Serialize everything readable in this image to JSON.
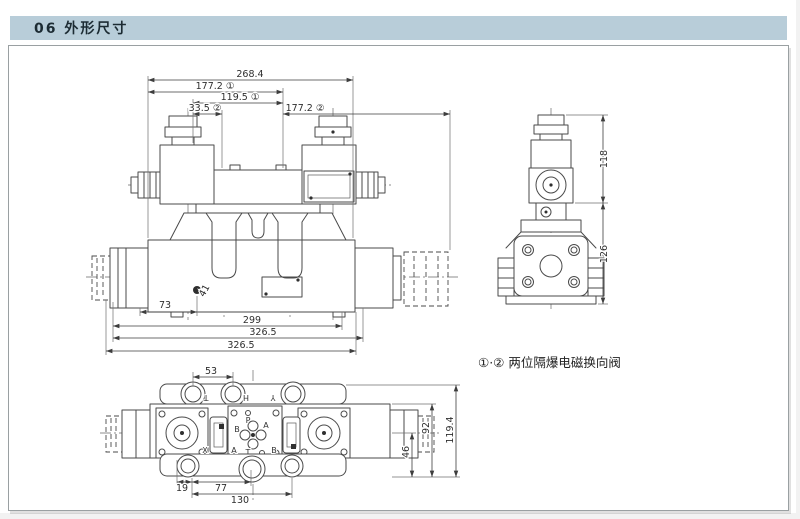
{
  "header": {
    "title": "06 外形尺寸"
  },
  "note": {
    "text": "①·② 两位隔爆电磁换向阀"
  },
  "front_view": {
    "dim_268_4": "268.4",
    "dim_177_2_a": "177.2 ①",
    "dim_119_5": "119.5 ①",
    "dim_33_5": "33.5 ②",
    "dim_177_2_b": "177.2 ②",
    "dim_73": "73",
    "dim_299": "299",
    "dim_326_5_a": "326.5",
    "dim_326_5_b": "326.5",
    "dim_41": "41"
  },
  "side_view": {
    "dim_118": "118",
    "dim_126": "126"
  },
  "bottom_view": {
    "dim_53": "53",
    "dim_19": "19",
    "dim_77": "77",
    "dim_130": "130",
    "dim_46": "46",
    "dim_92": "92",
    "dim_119_4": "119.4",
    "ports_top": [
      "T",
      "H",
      "Y"
    ],
    "ports_bottom": [
      "X",
      "A",
      "B"
    ],
    "center_ports": {
      "p": "P",
      "a": "A",
      "b": "B",
      "t": "T"
    }
  },
  "colors": {
    "header_bg": "#b8cdd9",
    "header_text": "#1c2b33",
    "drawing_line": "#4a4a4a",
    "page_bg": "#ffffff"
  }
}
